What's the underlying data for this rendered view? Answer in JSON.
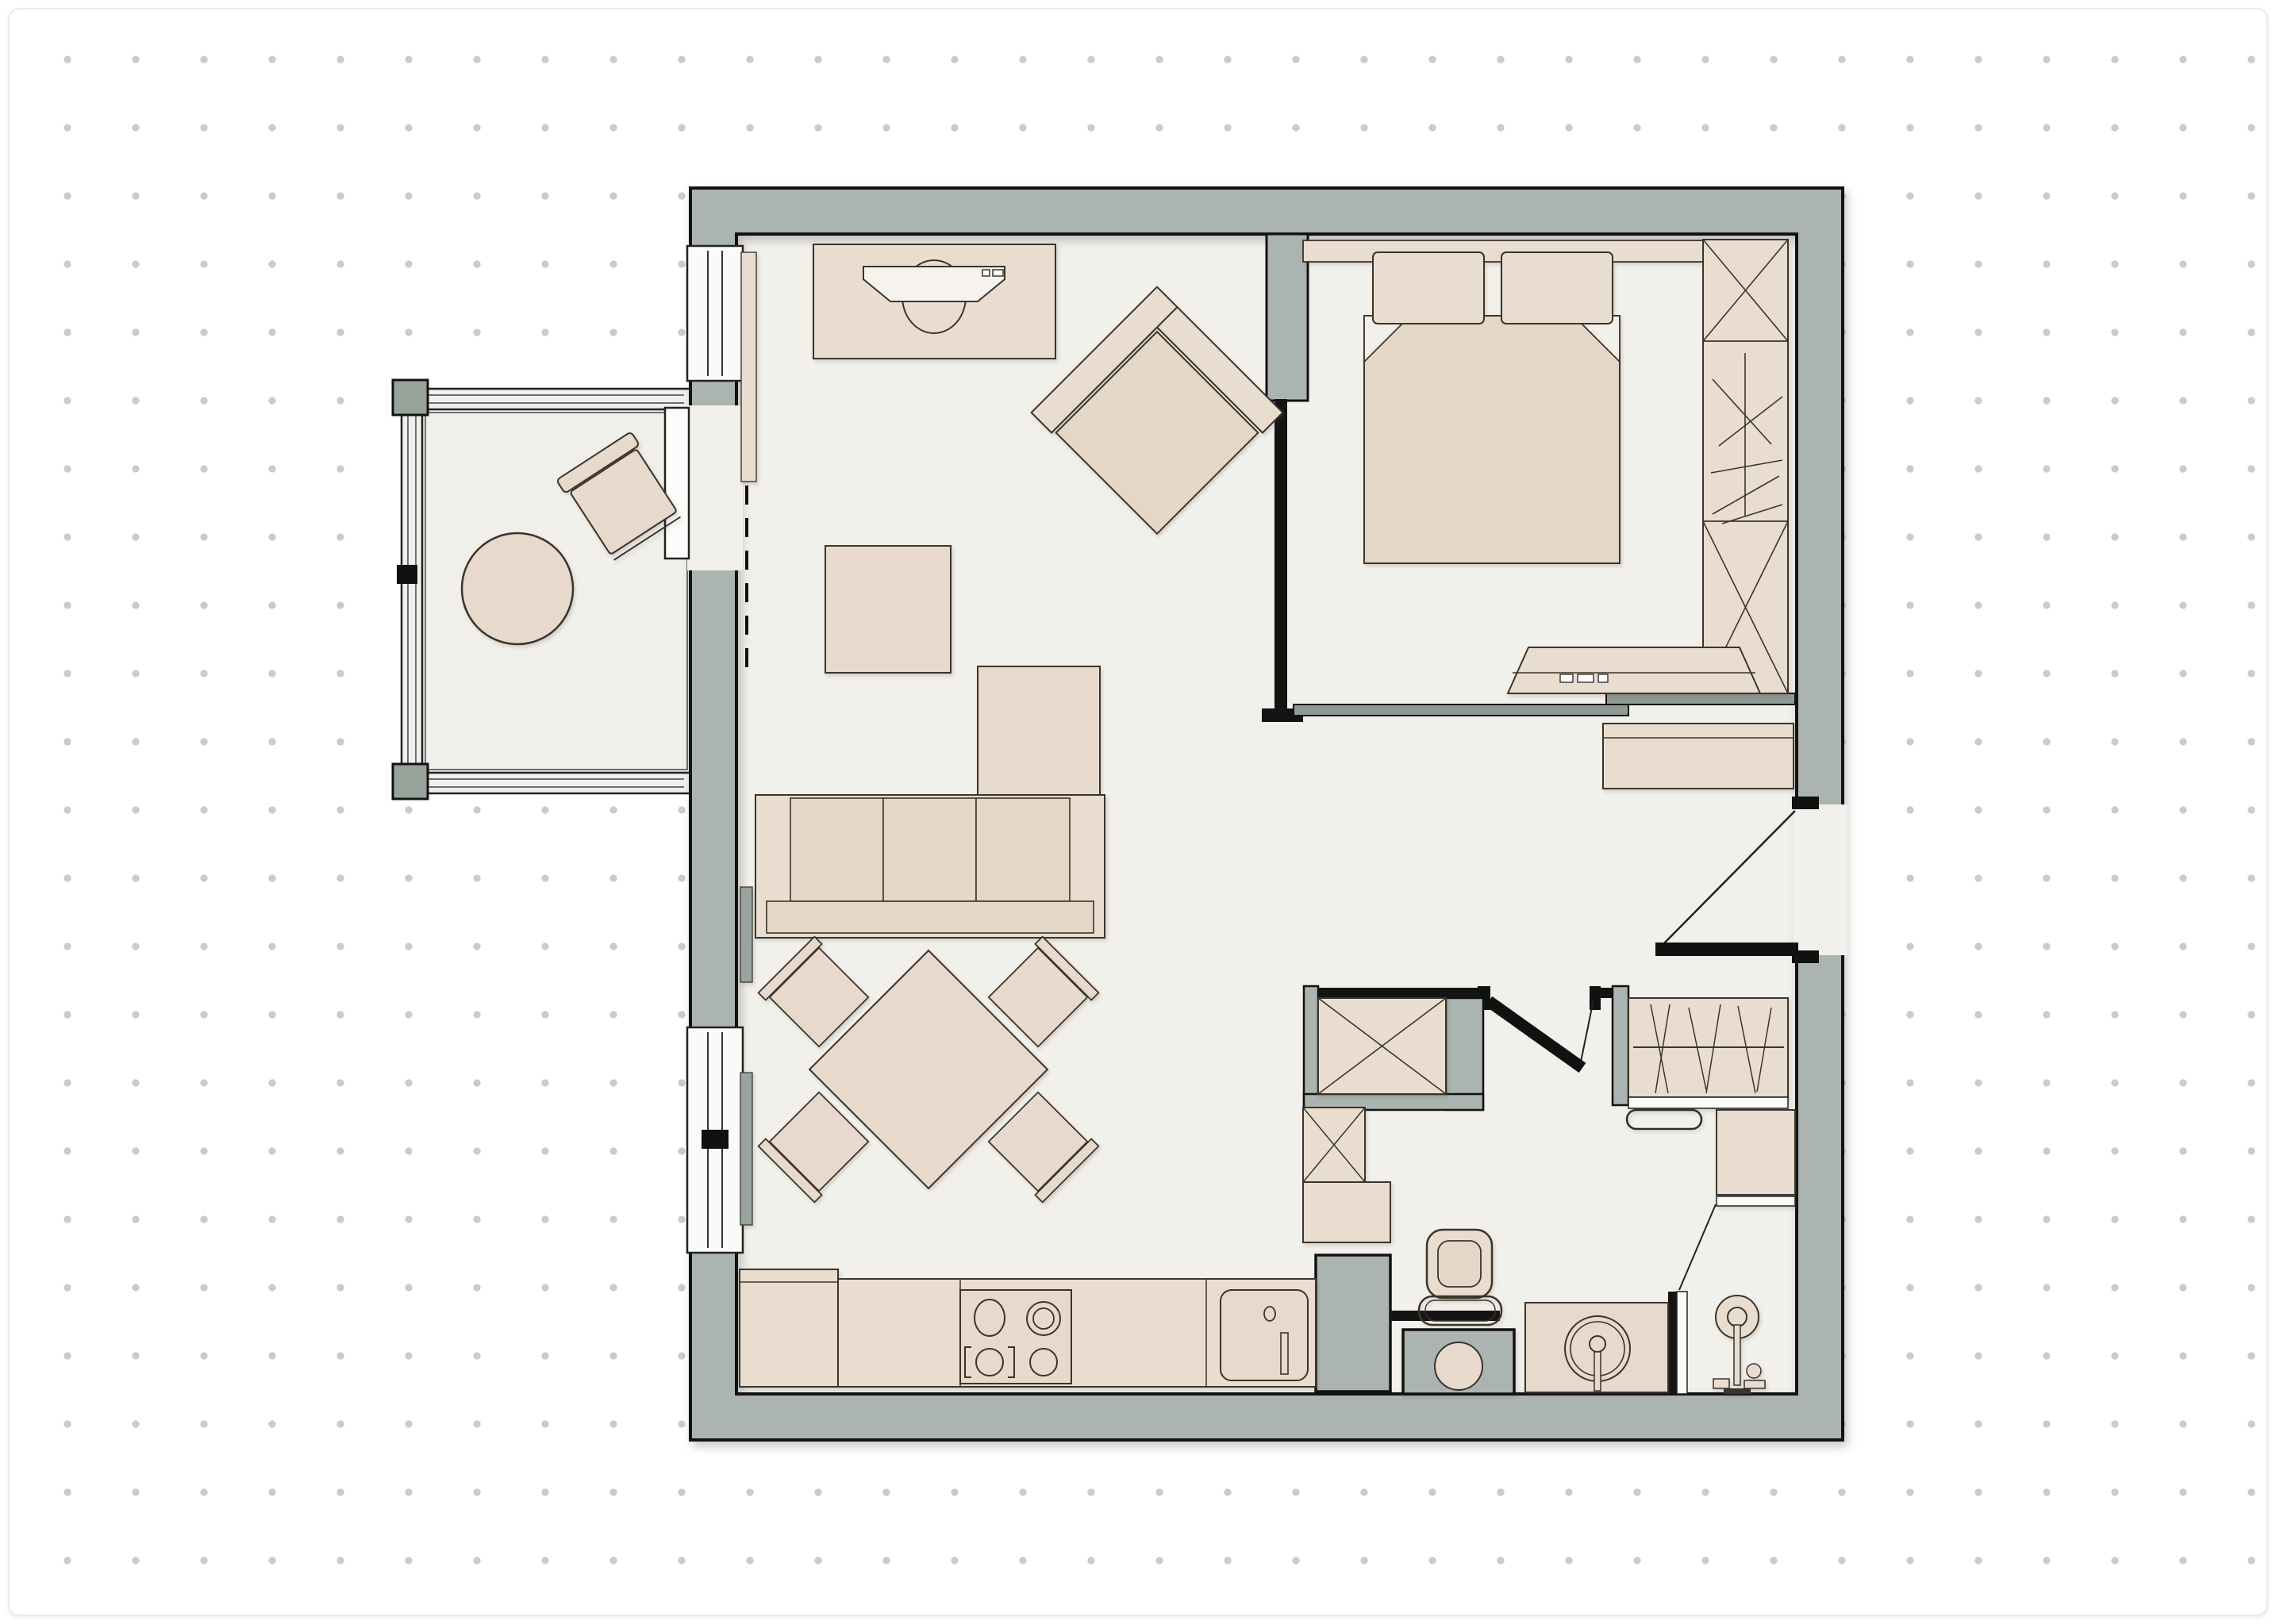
{
  "canvas": {
    "background": "#ffffff",
    "card_border": "#e9eaee",
    "dot_color": "#c7ccd1",
    "dot_spacing_px": 86
  },
  "palette": {
    "wall_fill": "#abb4b0",
    "wall_post": "#97a29b",
    "wall_outline": "#121212",
    "floor": "#f2f0ea",
    "furniture_light": "#e9ddd0",
    "furniture_mid": "#e5d7c8",
    "furniture_outline": "#3b342b",
    "glass": "#fafaf8",
    "door_leaf": "#8f9a94"
  },
  "plan": {
    "type": "apartment-floor-plan-top-view",
    "rooms": [
      {
        "id": "living-room",
        "furniture": [
          "tv-console",
          "tv",
          "wall-radiator",
          "armchair-rotated",
          "coffee-table",
          "sofa-3-seat",
          "console-table",
          "dining-table-rotated",
          "dining-chair x4",
          "curtain-panel x2"
        ]
      },
      {
        "id": "balcony",
        "furniture": [
          "round-table",
          "outdoor-chair"
        ]
      },
      {
        "id": "bedroom",
        "furniture": [
          "headboard-shelf",
          "pillow x2",
          "double-bed",
          "wardrobe-3-section",
          "tv-bench"
        ]
      },
      {
        "id": "hallway",
        "furniture": [
          "sideboard",
          "closet-hanging-rail",
          "closet-crossed"
        ]
      },
      {
        "id": "bathroom",
        "furniture": [
          "toilet",
          "washing-machine",
          "vanity-round-sink",
          "shower-set",
          "towel-rail",
          "shelf-cabinet",
          "storage-box-crossed",
          "tall-cabinet",
          "service-shaft"
        ]
      },
      {
        "id": "kitchen",
        "furniture": [
          "counter-run",
          "base-cabinet",
          "stove-4-burners",
          "kitchen-sink",
          "faucet"
        ]
      }
    ],
    "windows": [
      "living-left-upper-window",
      "living-left-lower-window"
    ],
    "doors": [
      "balcony-sliding-door",
      "bedroom-sliding-door",
      "bathroom-swing-door-open",
      "entry-swing-door-open"
    ]
  }
}
